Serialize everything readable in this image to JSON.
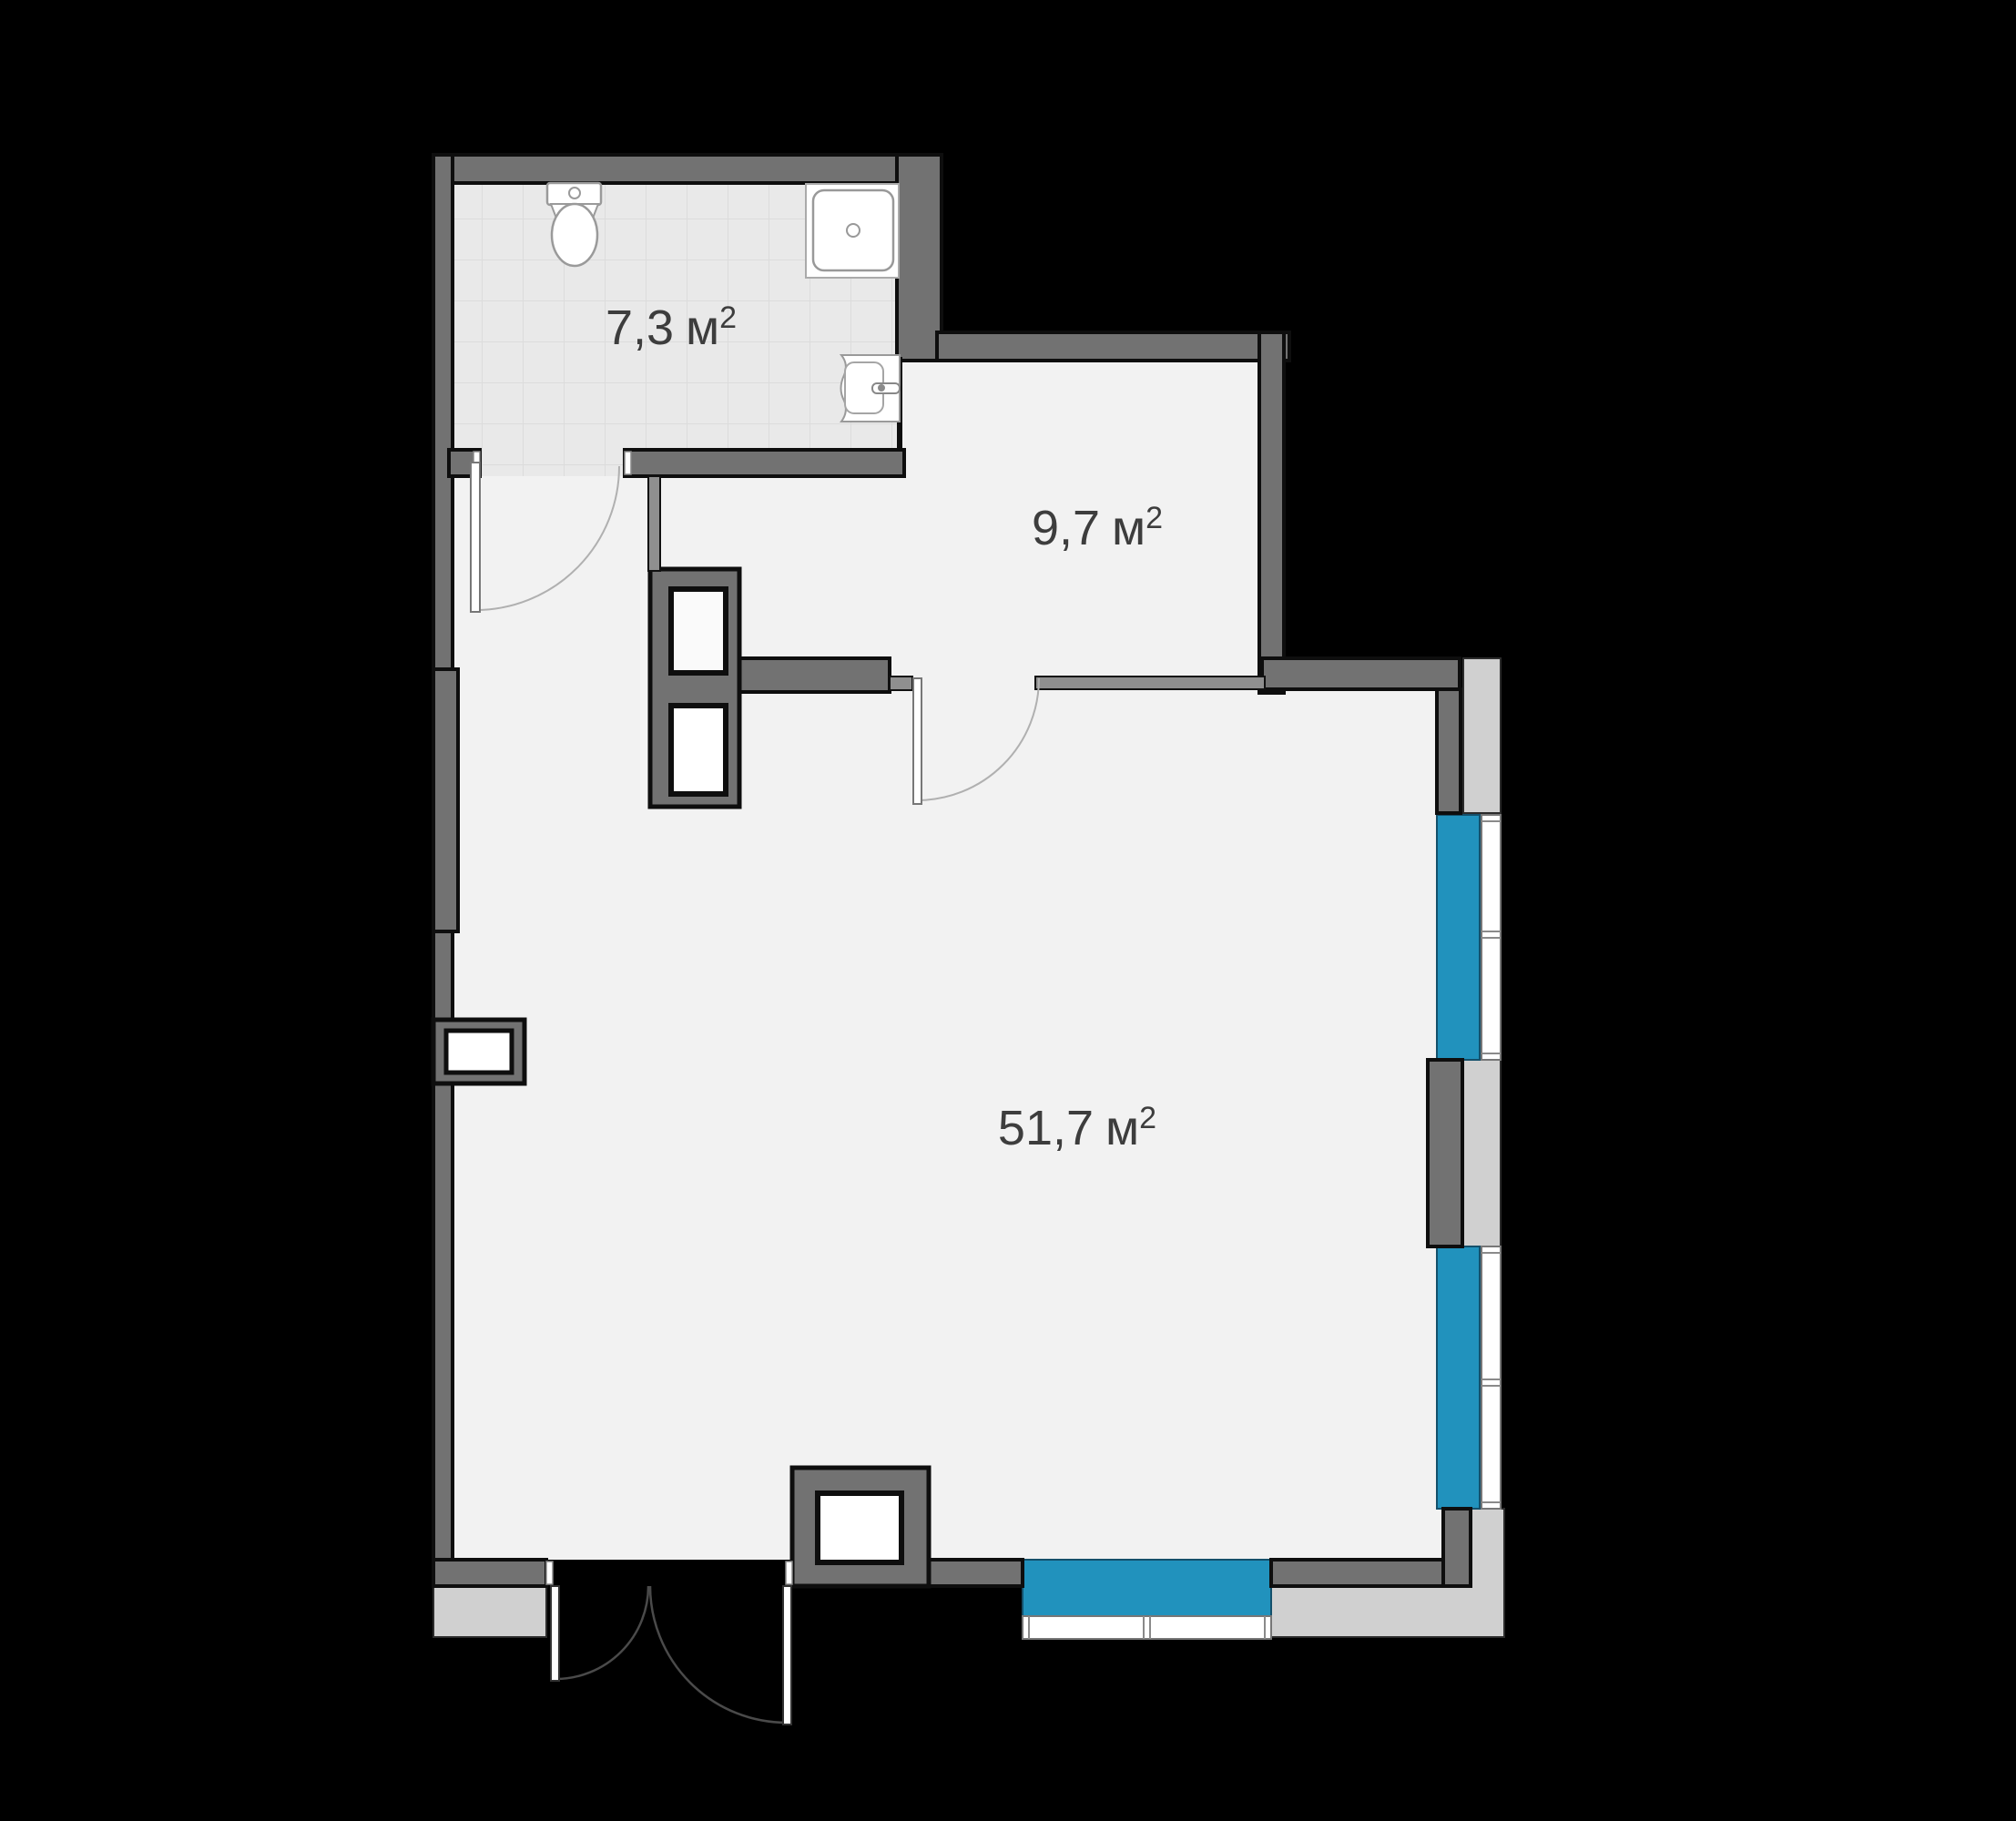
{
  "plan": {
    "type": "apartment-floor-plan",
    "rooms": [
      {
        "id": "bathroom",
        "value": "7,3",
        "unit": "м",
        "sup": "2"
      },
      {
        "id": "hallway",
        "value": "9,7",
        "unit": "м",
        "sup": "2"
      },
      {
        "id": "living-room",
        "value": "51,7",
        "unit": "м",
        "sup": "2"
      }
    ],
    "icons": [
      "toilet-icon",
      "sink-icon",
      "washbasin-icon",
      "door-swing-arc-icon",
      "ventilation-shaft-icon",
      "window-icon"
    ],
    "colors": {
      "background": "#000000",
      "wall": "#727272",
      "wall_light": "#8f8f8f",
      "outline": "#0e0e0e",
      "floor": "#f2f2f2",
      "bath_floor": "#e9e9e9",
      "tile_line": "#dcdcdc",
      "ledge": "#d0d0d0",
      "window_blue": "#2192bd",
      "frame_white": "#ffffff",
      "label_text": "#3d3d3d"
    }
  }
}
